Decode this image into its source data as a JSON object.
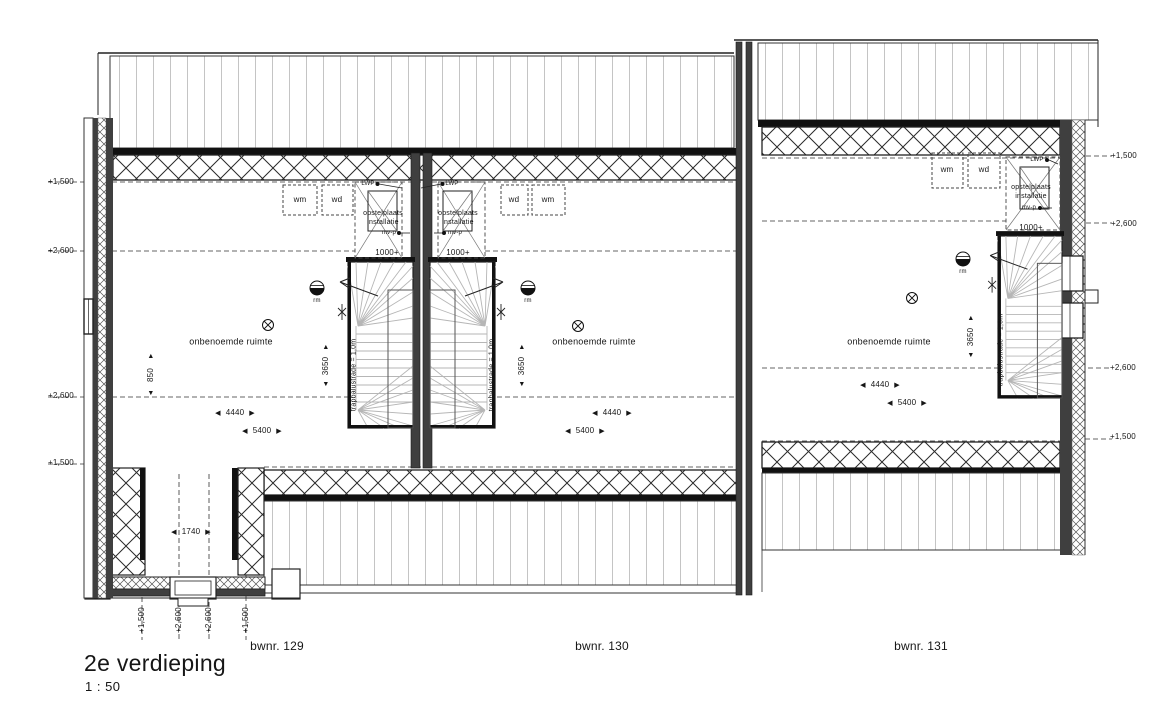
{
  "plan": {
    "title": "2e verdieping",
    "scale": "1 : 50",
    "units": [
      {
        "id": "129",
        "label": "bwnr. 129"
      },
      {
        "id": "130",
        "label": "bwnr. 130"
      },
      {
        "id": "131",
        "label": "bwnr. 131"
      }
    ],
    "labels": {
      "room": "onbenoemde ruimte",
      "installation": "opstelplaats installatie",
      "balustrade": "trapbalustrade = 1,0m",
      "headroom": "1000+",
      "washer": "wm",
      "dryer": "wd",
      "heatpump": "LWP",
      "ventilation": "mv-p",
      "smoke_detector": "rm"
    },
    "dimensions": {
      "hall_width": "1740",
      "room_width": "4440",
      "room_width_total": "5400",
      "room_depth": "3650",
      "wall_offset": "850"
    },
    "levels": {
      "low": "+1,500",
      "high": "+2,600"
    },
    "icons": {
      "arrow_left": "◀",
      "arrow_right": "▶",
      "arrow_up": "▲",
      "arrow_down": "▼"
    },
    "colors": {
      "line": "#1c1c1c",
      "wall_fill": "#404040",
      "stair_line": "#b6b6b6"
    }
  }
}
